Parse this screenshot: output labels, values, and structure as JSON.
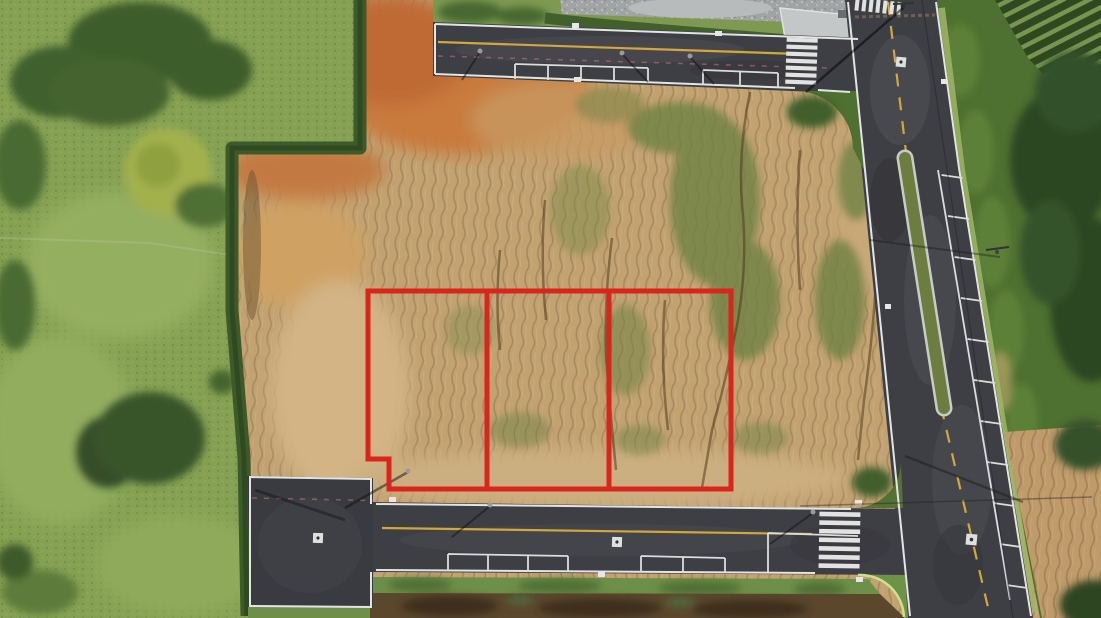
{
  "meta": {
    "content_type": "aerial-drone-photograph",
    "visible_text": "none",
    "subject": "Graded land development site with three vacant lots outlined in red"
  },
  "scene": {
    "description": "Top-down aerial drone photo of a new residential land development: a large graded bare-earth area with erosion channels and scrub regrowth, three side-by-side lots outlined in thick red lines, bounded by a dead-end street on the south, a street on the north, and a divided boulevard with a grass median on the east; green pasture with trees on the west.",
    "lots": {
      "count": 3,
      "outline_color": "#d9251c",
      "arrangement": "three equal side-by-side parcels fronting the south street",
      "detail": "small rectangular step notch cut out of the south-west corner of the left lot",
      "items": [
        {
          "id": "lot-1",
          "position": "west"
        },
        {
          "id": "lot-2",
          "position": "center"
        },
        {
          "id": "lot-3",
          "position": "east"
        }
      ]
    },
    "roads": [
      {
        "id": "north-street",
        "type": "two-lane asphalt street",
        "features": [
          "white edge outline with squared dead-end west cap",
          "solid yellow center line",
          "faint pink temporary dashed line",
          "two groups of marked parallel-parking bays",
          "zebra crosswalk at east end",
          "street lamps with shadows"
        ]
      },
      {
        "id": "south-street",
        "type": "two-lane asphalt dead-end street",
        "features": [
          "hammerhead turnaround pad at west end",
          "solid yellow center line",
          "white painted manhole squares",
          "marked parking bays",
          "white approach-lane line near intersection",
          "zebra crosswalk before east intersection"
        ]
      },
      {
        "id": "east-boulevard",
        "type": "divided asphalt boulevard running downhill to the south",
        "features": [
          "grass median island with rounded ends",
          "dashed yellow center line",
          "marked parallel-parking lane on east side",
          "zebra crosswalk at north end",
          "utility poles and overhead power line with long shadows",
          "white painted manhole squares"
        ]
      }
    ],
    "terrain": {
      "west": "green pasture with large tree clusters, one yellow-green tree, hedgerow boundary",
      "center": "bare graded earth, orange-red cut soil in the north-west, tan eroded soil with vertical gullies and green scrub patches",
      "north": "grey gravel stockpile area behind a hedge, small concrete pad at the intersection corner",
      "east": "grass verge, dense shrub band, diagonal orchard crop rows in the north-east corner, eroded tan bank in the south-east",
      "south": "grass verge strip and dark scrubby spoil strip below the street"
    },
    "marking_counts": {
      "crosswalks": 3,
      "painted_manhole_squares": 4,
      "parking_bay_groups_north_street": 2,
      "parking_bay_groups_south_street": 2,
      "red_lot_divider_lines": 2
    },
    "palette": {
      "asphalt": "#3e3f44",
      "asphalt_worn": "#4d4e54",
      "road_marking_white": "#e4e4e4",
      "road_marking_yellow": "#d2a83c",
      "temporary_marking_pink": "#cd827d",
      "lot_outline_red": "#d9251c",
      "bare_soil_tan": "#c2a271",
      "bare_soil_orange": "#c97a3e",
      "pale_soil": "#d2b485",
      "pasture_green": "#86a153",
      "tree_dark_green": "#3e5d2b",
      "hedge_green": "#3c5b29",
      "scrub_green": "#6d8142",
      "median_grass": "#6d7d40",
      "gravel_grey": "#a0a4a5",
      "concrete_grey": "#c3c7c8",
      "crop_rows_dark": "#30481f",
      "crop_rows_light": "#7f9c55"
    }
  }
}
